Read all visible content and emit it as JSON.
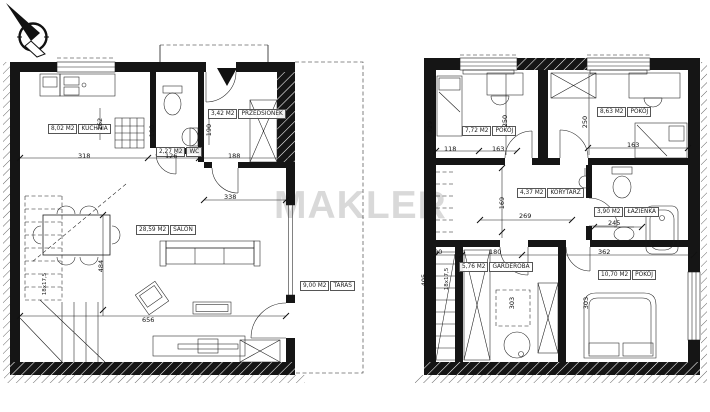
{
  "watermark": "MAKLER",
  "ground_floor": {
    "rooms": {
      "kuchnia": {
        "area": "8,02 M2",
        "name": "KUCHNIA"
      },
      "wc": {
        "area": "2,27 M2",
        "name": "WC"
      },
      "przedsionek": {
        "area": "3,42 M2",
        "name": "PRZEDSIONEK"
      },
      "salon": {
        "area": "28,59 M2",
        "name": "SALON"
      },
      "taras": {
        "area": "9,00 M2",
        "name": "TARAS"
      }
    },
    "dims": {
      "w_kitchen": "318",
      "w_wc": "126",
      "w_hall": "188",
      "h_wc": "190",
      "h_hall": "190",
      "h_kitchen": "162",
      "w_salon_top": "338",
      "h_salon": "484",
      "w_salon": "656",
      "stairs": "18x17,5"
    }
  },
  "upper_floor": {
    "rooms": {
      "pokoj_1": {
        "area": "7,72 M2",
        "name": "POKÓJ"
      },
      "pokoj_2": {
        "area": "8,63 M2",
        "name": "POKÓJ"
      },
      "korytarz": {
        "area": "4,37 M2",
        "name": "KORYTARZ"
      },
      "lazienka": {
        "area": "3,90 M2",
        "name": "ŁAZIENKA"
      },
      "garderoba": {
        "area": "5,76 M2",
        "name": "GARDEROBA"
      },
      "pokoj_3": {
        "area": "10,70 M2",
        "name": "POKÓJ"
      }
    },
    "dims": {
      "d118": "118",
      "d163a": "163",
      "d329": "329",
      "d250a": "250",
      "d250b": "250",
      "d163b": "163",
      "d169": "169",
      "d269": "269",
      "d245": "245",
      "d90": "90",
      "d180": "180",
      "d362": "362",
      "d405": "405",
      "d303a": "303",
      "d303b": "303",
      "stairs": "18x17,5"
    }
  }
}
